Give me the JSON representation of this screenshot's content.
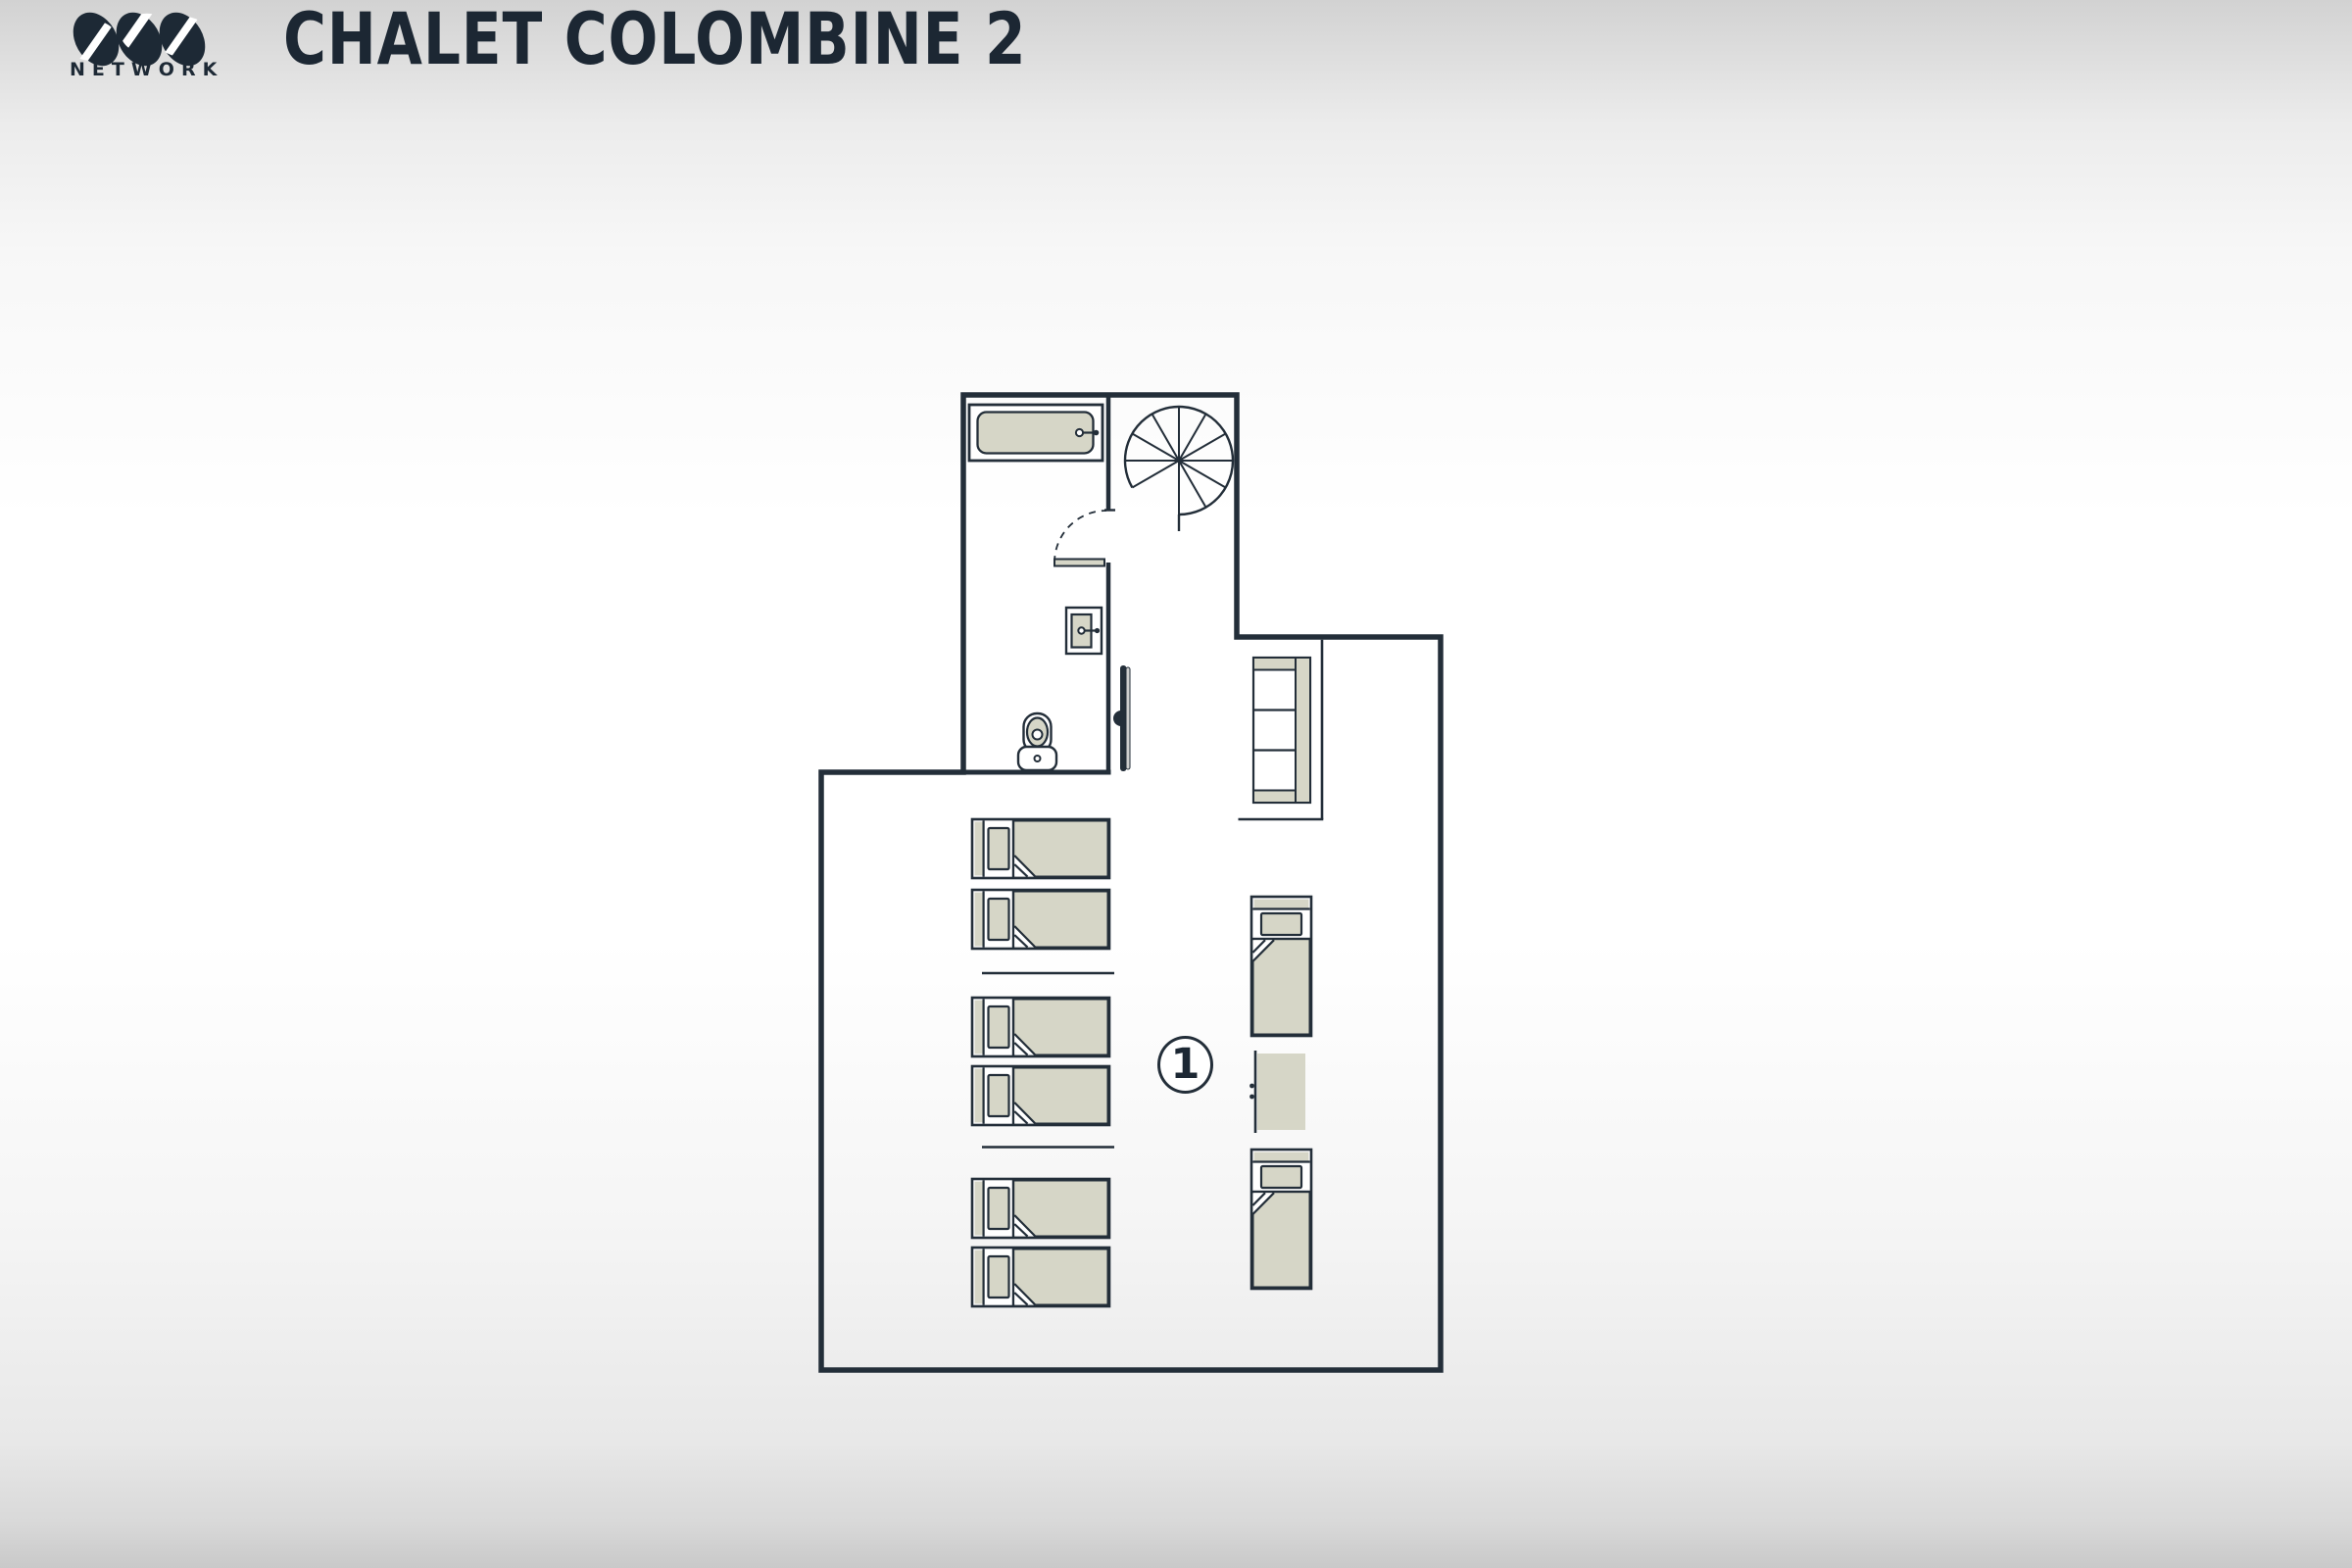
{
  "header": {
    "brand_name": "OVO",
    "brand_subtitle": "NETWORK",
    "title": "CHALET COLOMBINE 2"
  },
  "plan": {
    "room_label": "1",
    "colors": {
      "wall_ink": "#232e39",
      "furniture_beige": "#d6d6c7",
      "tv_screen_gray": "#cdcdcd",
      "paper_white": "#ffffff"
    },
    "rooms": [
      {
        "label": "1",
        "type": "bedroom"
      }
    ],
    "bed_count": 8,
    "furniture_icons": [
      "bathtub-icon",
      "spiral-staircase-icon",
      "door-swing-icon",
      "washbasin-icon",
      "wall-tv-icon",
      "toilet-icon",
      "sofa-icon",
      "single-bed-icon",
      "chest-of-drawers-icon"
    ]
  }
}
